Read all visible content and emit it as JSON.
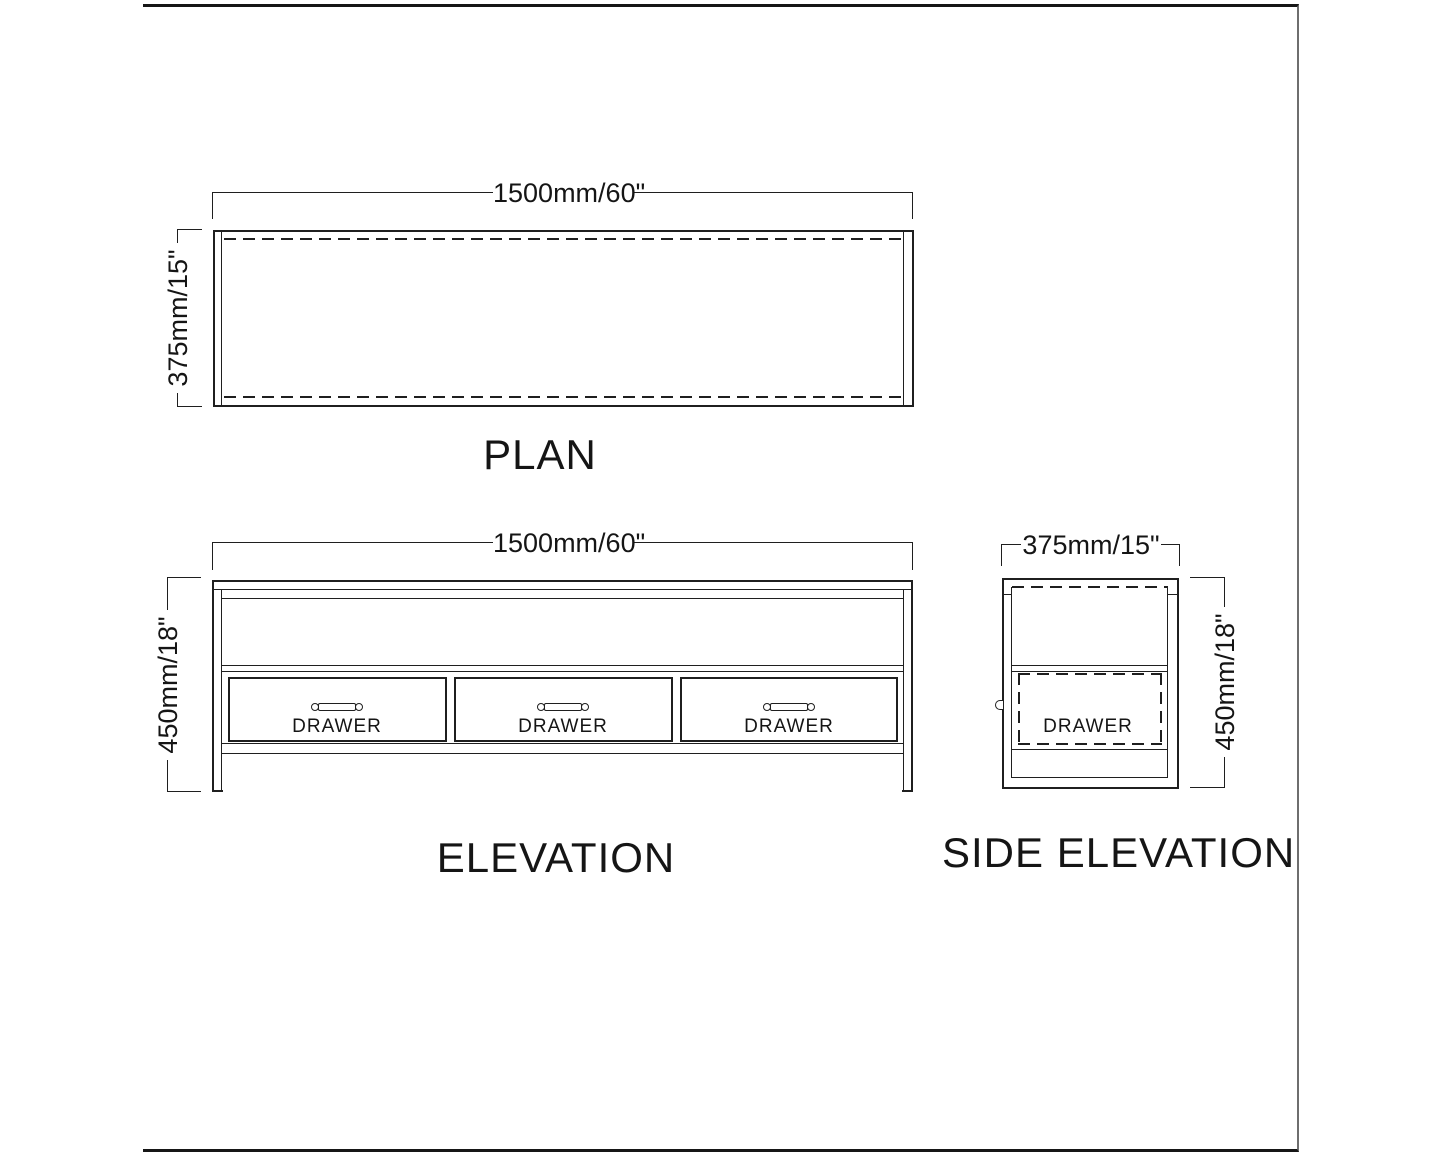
{
  "sheet": {
    "background": "#ffffff",
    "line_color": "#1f1f1f"
  },
  "plan": {
    "title": "PLAN",
    "dim_width": "1500mm/60\"",
    "dim_depth": "375mm/15\""
  },
  "elevation": {
    "title": "ELEVATION",
    "dim_width": "1500mm/60\"",
    "dim_height": "450mm/18\"",
    "drawers": [
      "DRAWER",
      "DRAWER",
      "DRAWER"
    ]
  },
  "side_elevation": {
    "title": "SIDE ELEVATION",
    "dim_depth": "375mm/15\"",
    "dim_height": "450mm/18\"",
    "drawer_label": "DRAWER"
  }
}
